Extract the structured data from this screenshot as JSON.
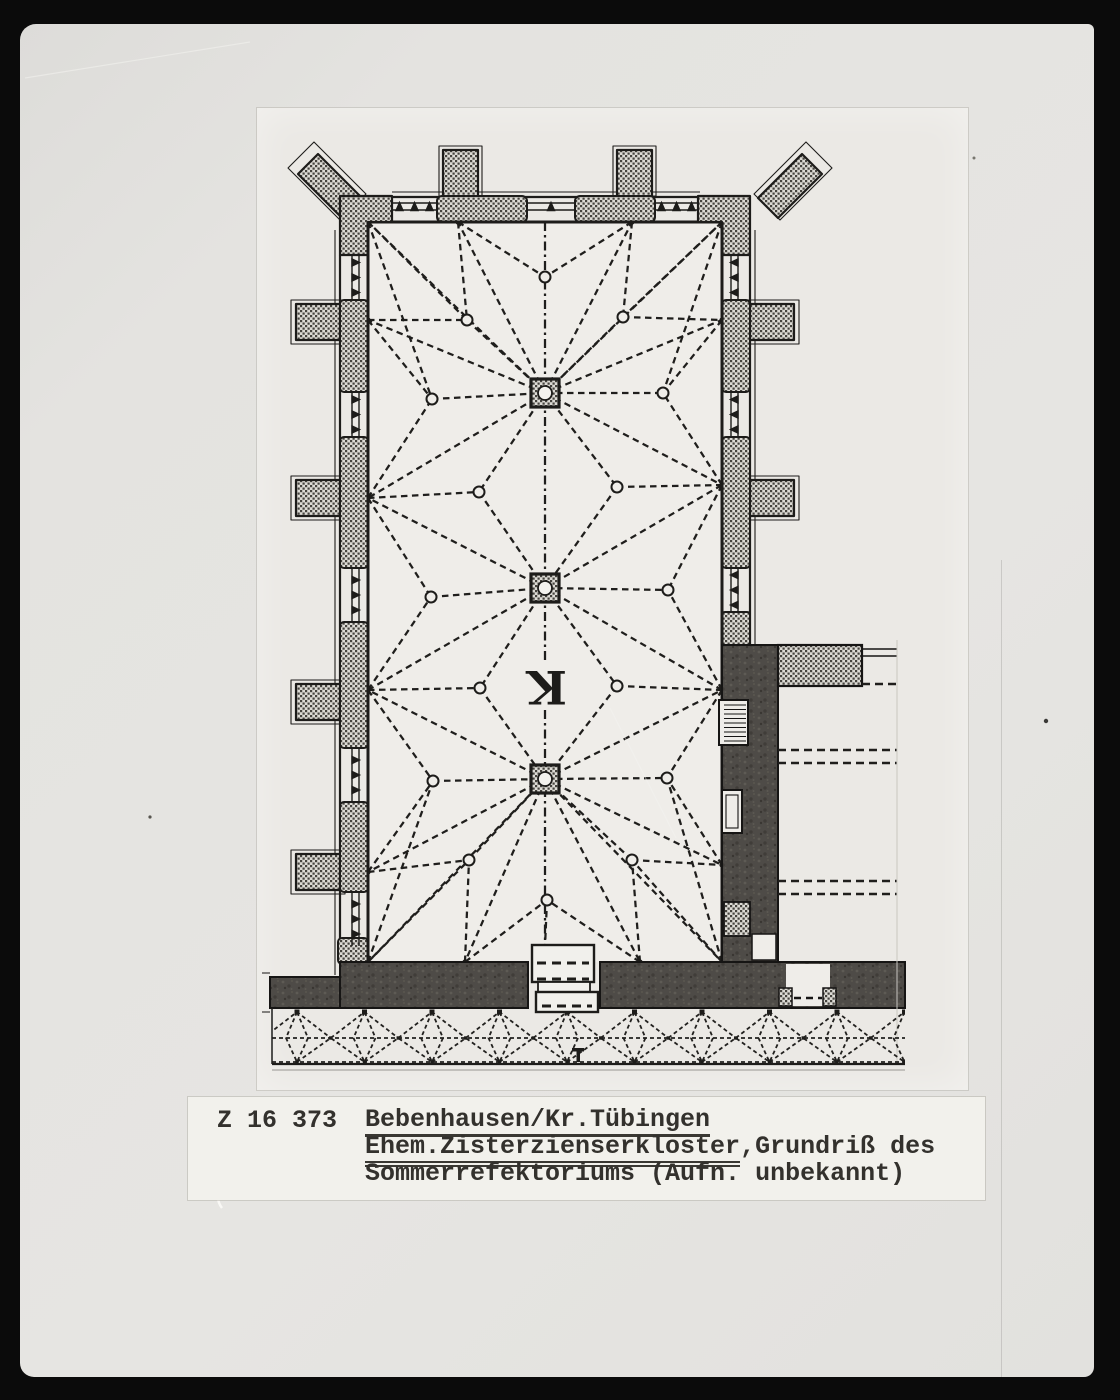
{
  "caption": {
    "catalog_number": "Z 16 373",
    "line1": "Bebenhausen/Kr.Tübingen",
    "line2_underlined": "Ehem.Zisterzienserkloster",
    "line2_rest": ",Grundriß des",
    "line3": "Sommerrefektoriums (Aufn. unbekannt)"
  },
  "plan": {
    "type": "architectural-floor-plan",
    "room_label": "K",
    "columns": [
      [
        545,
        393
      ],
      [
        545,
        588
      ],
      [
        545,
        779
      ]
    ],
    "anchors": {
      "top": [
        [
          458,
          222
        ],
        [
          632,
          222
        ]
      ],
      "bottom": [
        [
          465,
          962
        ],
        [
          640,
          962
        ]
      ],
      "left": [
        [
          368,
          320
        ],
        [
          368,
          498
        ],
        [
          368,
          690
        ],
        [
          368,
          872
        ]
      ],
      "right": [
        [
          722,
          320
        ],
        [
          722,
          485
        ],
        [
          722,
          690
        ],
        [
          722,
          865
        ]
      ],
      "corners": {
        "tl": [
          368,
          222
        ],
        "tr": [
          722,
          222
        ],
        "bl": [
          368,
          962
        ],
        "br": [
          722,
          962
        ]
      }
    },
    "bosses": {
      "axis_top": [
        545,
        277
      ],
      "axis_bottom": [
        547,
        900
      ],
      "top_bay": [
        [
          467,
          320
        ],
        [
          623,
          317
        ]
      ],
      "bottom_bay": [
        [
          469,
          860
        ],
        [
          632,
          860
        ]
      ],
      "side_left": [
        [
          432,
          399
        ],
        [
          431,
          597
        ],
        [
          433,
          781
        ]
      ],
      "side_right": [
        [
          663,
          393
        ],
        [
          668,
          590
        ],
        [
          667,
          778
        ]
      ],
      "mid_left": [
        [
          479,
          492
        ],
        [
          480,
          688
        ]
      ],
      "mid_right": [
        [
          617,
          487
        ],
        [
          617,
          686
        ]
      ]
    },
    "cloister": {
      "start_x": 297,
      "spacing": 67.5,
      "count": 10,
      "top": 1012,
      "mid": 1038,
      "bottom": 1062,
      "clip": [
        272,
        1009,
        633,
        58
      ]
    }
  },
  "colors": {
    "scan_background": "#0b0b0b",
    "paper": "#e4e3e0",
    "print": "#ebe9e5",
    "caption_background": "#f2f1ec",
    "ink": "#1d1c1a",
    "dark_wall": "#4e4b47",
    "hatch_dark": "#45433e",
    "interior": "#efede9"
  }
}
